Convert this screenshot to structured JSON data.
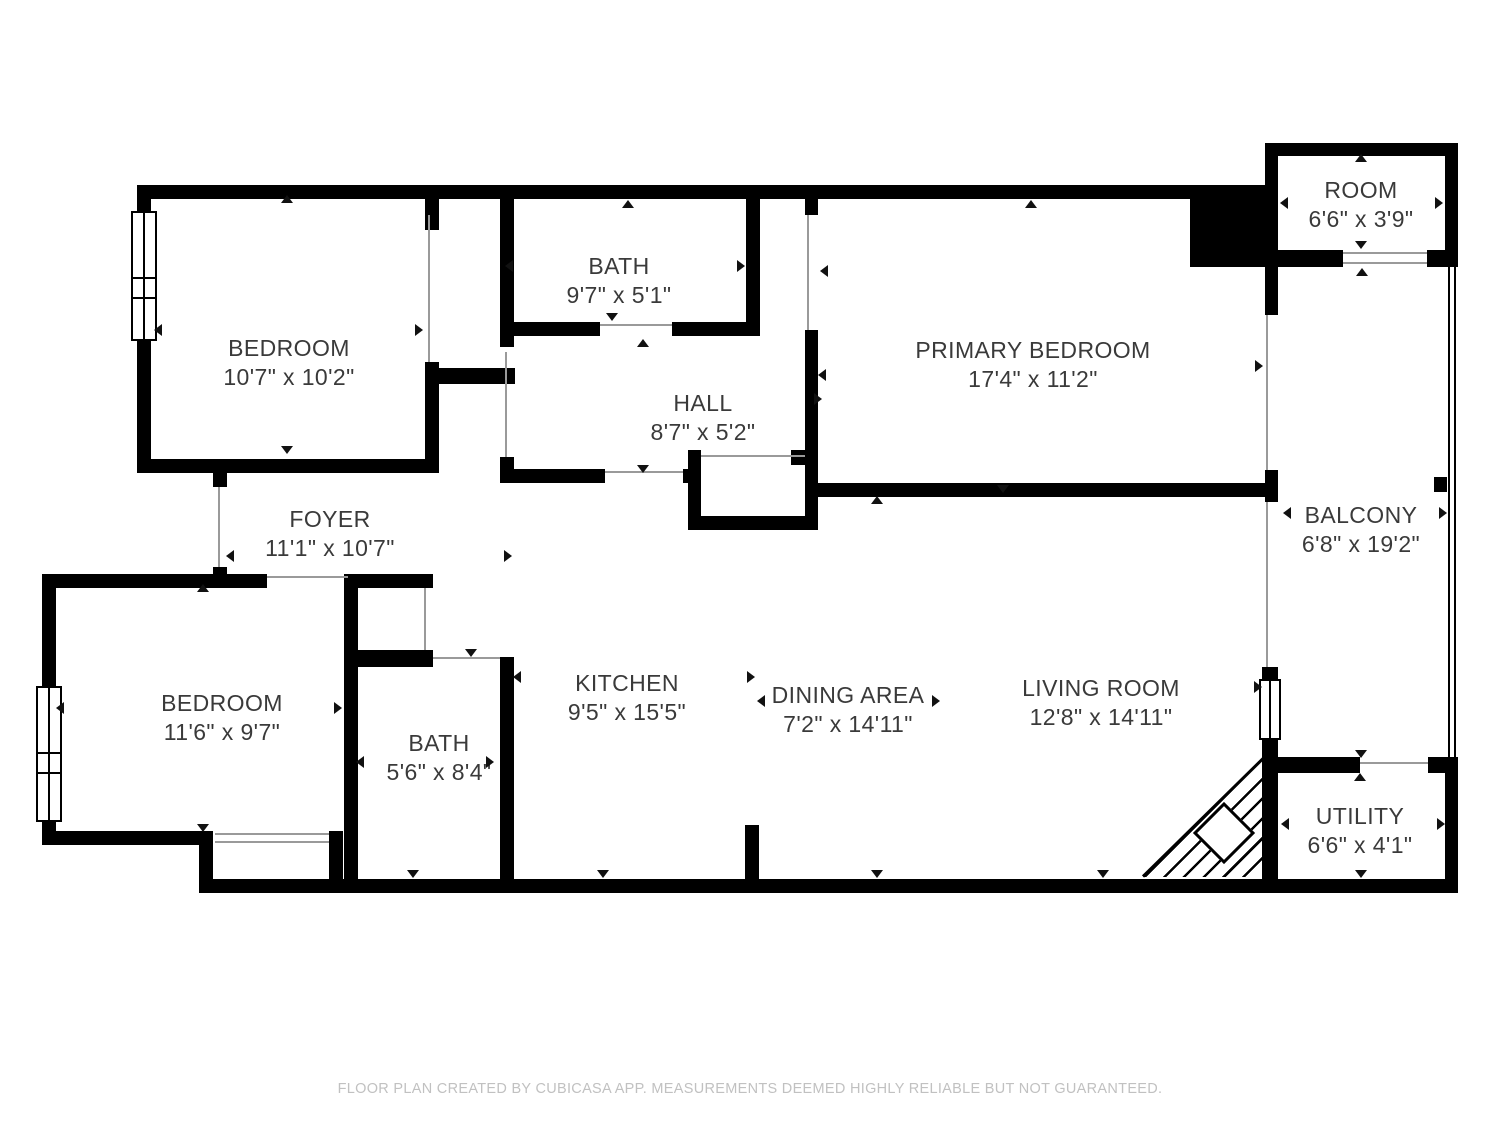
{
  "floor_plan": {
    "rooms": [
      {
        "id": "bedroom-top-left",
        "name": "BEDROOM",
        "dimensions": "10'7\" x 10'2\""
      },
      {
        "id": "bath-top",
        "name": "BATH",
        "dimensions": "9'7\" x 5'1\""
      },
      {
        "id": "hall",
        "name": "HALL",
        "dimensions": "8'7\" x 5'2\""
      },
      {
        "id": "primary-bedroom",
        "name": "PRIMARY BEDROOM",
        "dimensions": "17'4\" x 11'2\""
      },
      {
        "id": "room-top-right",
        "name": "ROOM",
        "dimensions": "6'6\" x 3'9\""
      },
      {
        "id": "foyer",
        "name": "FOYER",
        "dimensions": "11'1\" x 10'7\""
      },
      {
        "id": "bedroom-bottom-left",
        "name": "BEDROOM",
        "dimensions": "11'6\" x 9'7\""
      },
      {
        "id": "bath-bottom",
        "name": "BATH",
        "dimensions": "5'6\" x 8'4\""
      },
      {
        "id": "kitchen",
        "name": "KITCHEN",
        "dimensions": "9'5\" x 15'5\""
      },
      {
        "id": "dining-area",
        "name": "DINING AREA",
        "dimensions": "7'2\" x 14'11\""
      },
      {
        "id": "living-room",
        "name": "LIVING ROOM",
        "dimensions": "12'8\" x 14'11\""
      },
      {
        "id": "balcony",
        "name": "BALCONY",
        "dimensions": "6'8\" x 19'2\""
      },
      {
        "id": "utility",
        "name": "UTILITY",
        "dimensions": "6'6\" x 4'1\""
      }
    ],
    "footer": "FLOOR PLAN CREATED BY CUBICASA APP. MEASUREMENTS DEEMED HIGHLY RELIABLE BUT NOT GUARANTEED.",
    "colors": {
      "wall": "#000000",
      "background": "#ffffff",
      "label_text": "#3a3a3a",
      "footer_text": "#c1c1c1",
      "door_line": "#9a9a9a"
    }
  }
}
